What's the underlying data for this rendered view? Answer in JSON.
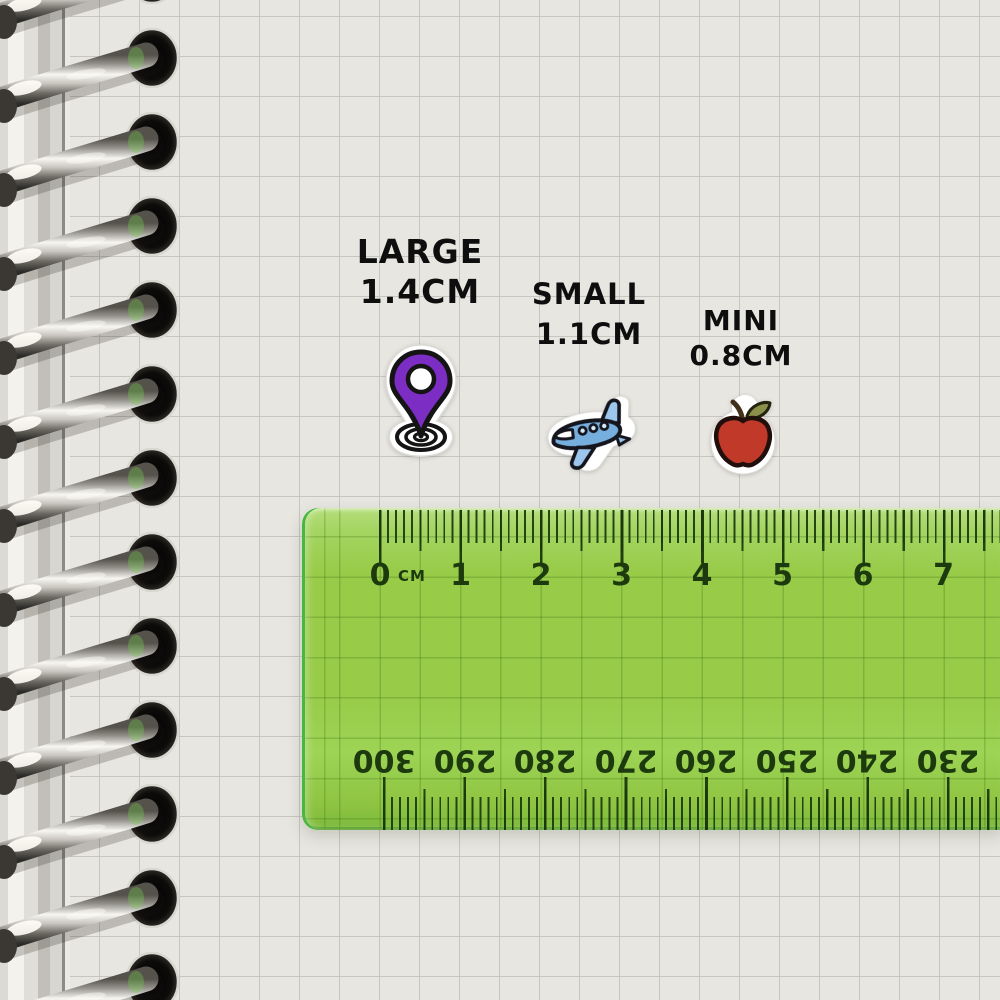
{
  "size_labels": {
    "large": {
      "title": "LARGE",
      "size": "1.4CM"
    },
    "small": {
      "title": "SMALL",
      "size": "1.1CM"
    },
    "mini": {
      "title": "MINI",
      "size": "0.8CM"
    }
  },
  "stickers": {
    "large": {
      "icon": "location-pin-sticker",
      "color": "#7c2ec4"
    },
    "small": {
      "icon": "airplane-sticker",
      "color": "#76aede"
    },
    "mini": {
      "icon": "apple-sticker",
      "color": "#c13928"
    }
  },
  "ruler": {
    "unit_label": "CM",
    "top_scale_numbers": [
      "0",
      "1",
      "2",
      "3",
      "4",
      "5",
      "6",
      "7"
    ],
    "bottom_scale_numbers": [
      "300",
      "290",
      "280",
      "270",
      "260",
      "250",
      "240",
      "230"
    ],
    "body_color": "#9acd51",
    "marking_color": "#1c3a0e"
  },
  "notebook": {
    "paper_color": "#e8e6e1",
    "grid_color": "#c7c5bf",
    "binding": "spiral-binding"
  }
}
